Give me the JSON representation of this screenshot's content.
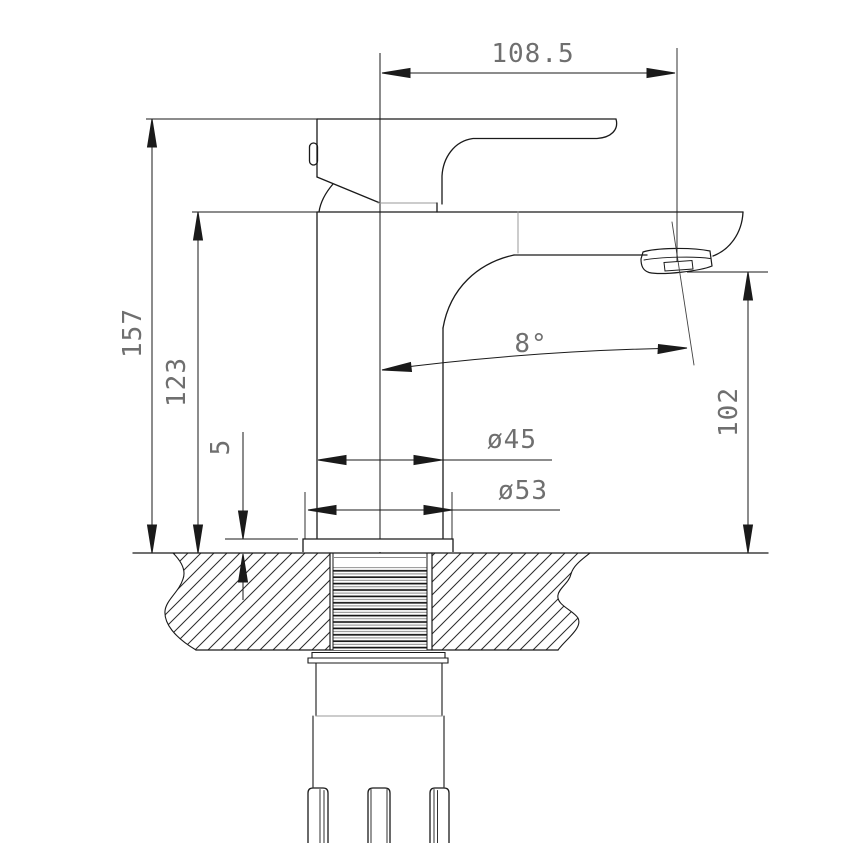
{
  "dims": {
    "top_width": {
      "label": "108.5"
    },
    "overall_height": {
      "label": "157"
    },
    "body_height": {
      "label": "123"
    },
    "plate_thickness": {
      "label": "5"
    },
    "body_diameter": {
      "label": "ø45"
    },
    "base_diameter": {
      "label": "ø53"
    },
    "spout_height": {
      "label": "102"
    },
    "spout_angle": {
      "label": "8°"
    }
  },
  "style": {
    "line_color": "#1a1a1a",
    "thin_line_color": "#999999",
    "dim_text_color": "#6f6f6f",
    "background": "#ffffff"
  }
}
